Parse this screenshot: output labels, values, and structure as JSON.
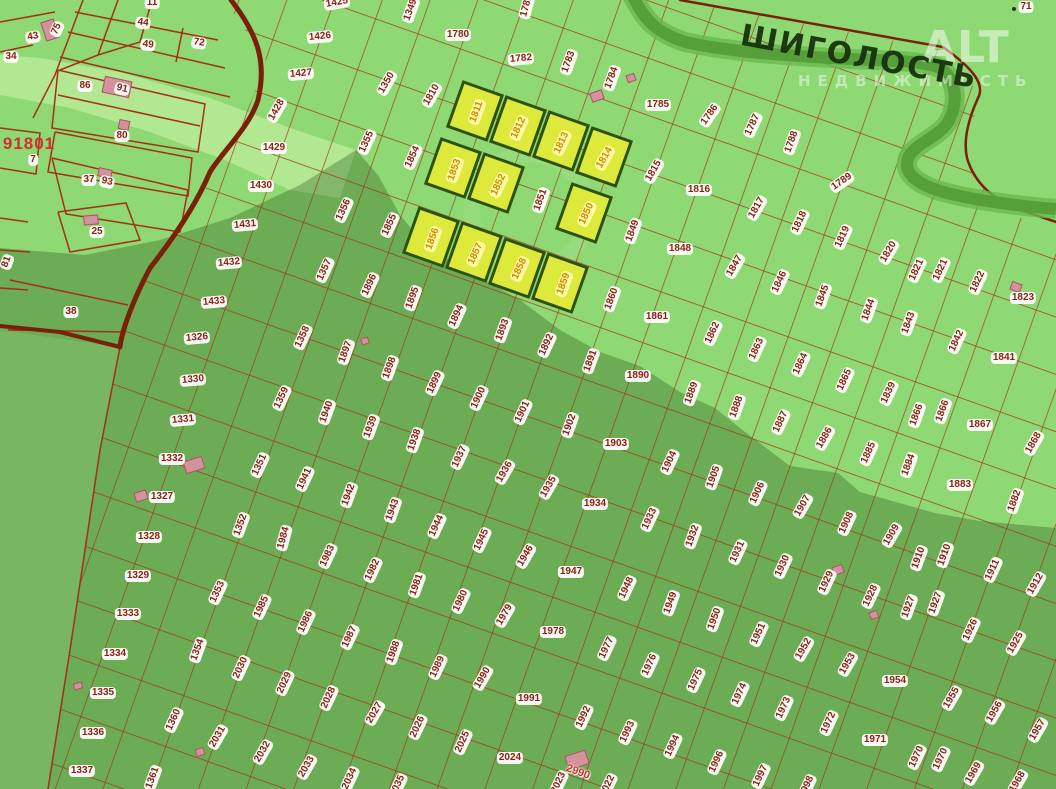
{
  "place": {
    "name": "ШИГОЛОСТЬ"
  },
  "watermark": {
    "brand": "ALT",
    "tagline": "НЕДВИЖИМОСТЬ"
  },
  "colors": {
    "background_green": "#8ed973",
    "shadow_overlay": "rgba(25,70,15,0.30)",
    "parcel_line": "#a43016",
    "road": "#7a2008",
    "river": "#569f3b",
    "label_text": "#8c1d12",
    "label_bg": "#ffffff",
    "highlight_parcel_fill": "#dde93b",
    "highlight_parcel_border": "#2c5212",
    "highlight_label_text": "#d28a00",
    "highlight_label_bg": "#fffaaa",
    "building_pink": "#d3939c",
    "red_text": "#d32f2f",
    "place_text": "#17320d"
  },
  "highlighted_parcels": {
    "size": {
      "w": 44,
      "h": 50,
      "rotation": 19.5
    },
    "centers": [
      [
        475,
        111
      ],
      [
        518,
        126
      ],
      [
        561,
        141
      ],
      [
        604,
        157
      ],
      [
        453,
        168
      ],
      [
        496,
        183
      ],
      [
        584,
        213
      ],
      [
        431,
        237
      ],
      [
        474,
        252
      ],
      [
        517,
        268
      ],
      [
        560,
        283
      ]
    ]
  },
  "buildings": [
    [
      50,
      30,
      14,
      20,
      -18
    ],
    [
      117,
      87,
      28,
      17,
      12
    ],
    [
      124,
      125,
      11,
      10,
      12
    ],
    [
      105,
      173,
      14,
      9,
      12
    ],
    [
      91,
      220,
      15,
      10,
      -5
    ],
    [
      597,
      96,
      13,
      10,
      -20
    ],
    [
      631,
      78,
      9,
      8,
      -20
    ],
    [
      194,
      465,
      20,
      13,
      -18
    ],
    [
      141,
      496,
      13,
      10,
      -18
    ],
    [
      365,
      341,
      8,
      7,
      -20
    ],
    [
      1016,
      287,
      9,
      11,
      -70
    ],
    [
      838,
      570,
      11,
      9,
      -20
    ],
    [
      874,
      615,
      9,
      8,
      -20
    ],
    [
      577,
      760,
      22,
      15,
      -18
    ],
    [
      200,
      752,
      9,
      8,
      -20
    ],
    [
      78,
      686,
      9,
      7,
      -18
    ]
  ],
  "labels": [
    [
      "11",
      152,
      3,
      0,
      0
    ],
    [
      "44",
      143,
      23,
      8,
      0
    ],
    [
      "49",
      148,
      45,
      8,
      0
    ],
    [
      "72",
      199,
      43,
      8,
      0
    ],
    [
      "43",
      33,
      37,
      -10,
      0
    ],
    [
      "75",
      57,
      29,
      -65,
      0
    ],
    [
      "34",
      11,
      57,
      0,
      0
    ],
    [
      "86",
      85,
      86,
      0,
      0
    ],
    [
      "91",
      122,
      89,
      12,
      0
    ],
    [
      "80",
      122,
      136,
      0,
      0
    ],
    [
      "7",
      33,
      160,
      0,
      0
    ],
    [
      "37",
      89,
      180,
      0,
      0
    ],
    [
      "93",
      107,
      182,
      12,
      0
    ],
    [
      "25",
      97,
      232,
      0,
      0
    ],
    [
      "81",
      7,
      262,
      -70,
      0
    ],
    [
      "38",
      71,
      312,
      0,
      0
    ],
    [
      "91801",
      29,
      144,
      0,
      3
    ],
    [
      "71",
      1026,
      7,
      0,
      0
    ],
    [
      "1425",
      337,
      3,
      -10,
      0
    ],
    [
      "1426",
      320,
      37,
      -5,
      0
    ],
    [
      "1427",
      301,
      74,
      -5,
      0
    ],
    [
      "1428",
      277,
      110,
      -60,
      0
    ],
    [
      "1429",
      274,
      148,
      0,
      0
    ],
    [
      "1430",
      261,
      186,
      0,
      0
    ],
    [
      "1431",
      245,
      225,
      -5,
      0
    ],
    [
      "1432",
      229,
      263,
      -5,
      0
    ],
    [
      "1433",
      214,
      302,
      -5,
      0
    ],
    [
      "1326",
      197,
      338,
      -5,
      0
    ],
    [
      "1330",
      193,
      380,
      -5,
      0
    ],
    [
      "1331",
      183,
      420,
      -5,
      0
    ],
    [
      "1349",
      411,
      10,
      -70,
      0
    ],
    [
      "1350",
      387,
      83,
      -60,
      0
    ],
    [
      "1355",
      367,
      142,
      -65,
      0
    ],
    [
      "1356",
      344,
      210,
      -65,
      0
    ],
    [
      "1357",
      325,
      270,
      -65,
      0
    ],
    [
      "1358",
      303,
      337,
      -65,
      0
    ],
    [
      "1359",
      282,
      398,
      -65,
      0
    ],
    [
      "1780",
      458,
      35,
      0,
      0
    ],
    [
      "1781",
      527,
      6,
      -75,
      0
    ],
    [
      "1782",
      521,
      59,
      -5,
      0
    ],
    [
      "1783",
      569,
      62,
      -70,
      0
    ],
    [
      "1784",
      612,
      78,
      -70,
      0
    ],
    [
      "1785",
      658,
      105,
      0,
      0
    ],
    [
      "1786",
      710,
      115,
      -55,
      0
    ],
    [
      "1787",
      753,
      125,
      -65,
      0
    ],
    [
      "1788",
      792,
      142,
      -70,
      0
    ],
    [
      "1789",
      842,
      182,
      -35,
      0
    ],
    [
      "1810",
      432,
      95,
      -60,
      0
    ],
    [
      "1854",
      413,
      157,
      -65,
      0
    ],
    [
      "1855",
      390,
      225,
      -65,
      0
    ],
    [
      "1811",
      477,
      112,
      -70,
      1
    ],
    [
      "1812",
      519,
      128,
      -65,
      1
    ],
    [
      "1813",
      562,
      143,
      -65,
      1
    ],
    [
      "1814",
      605,
      158,
      -60,
      1
    ],
    [
      "1853",
      455,
      170,
      -70,
      1
    ],
    [
      "1852",
      499,
      185,
      -65,
      1
    ],
    [
      "1850",
      587,
      214,
      -65,
      1
    ],
    [
      "1856",
      433,
      239,
      -70,
      1
    ],
    [
      "1857",
      476,
      254,
      -65,
      1
    ],
    [
      "1858",
      520,
      269,
      -65,
      1
    ],
    [
      "1859",
      564,
      284,
      -70,
      1
    ],
    [
      "1851",
      541,
      200,
      -70,
      0
    ],
    [
      "1815",
      654,
      171,
      -60,
      0
    ],
    [
      "1816",
      699,
      190,
      0,
      0
    ],
    [
      "1817",
      757,
      208,
      -60,
      0
    ],
    [
      "1818",
      800,
      222,
      -65,
      0
    ],
    [
      "1819",
      843,
      237,
      -65,
      0
    ],
    [
      "1820",
      889,
      252,
      -60,
      0
    ],
    [
      "1821",
      917,
      270,
      -65,
      0
    ],
    [
      "1821",
      941,
      270,
      -65,
      0
    ],
    [
      "1822",
      978,
      282,
      -65,
      0
    ],
    [
      "1823",
      1023,
      298,
      0,
      0
    ],
    [
      "1849",
      633,
      231,
      -70,
      0
    ],
    [
      "1848",
      680,
      249,
      0,
      0
    ],
    [
      "1847",
      735,
      266,
      -60,
      0
    ],
    [
      "1846",
      780,
      282,
      -65,
      0
    ],
    [
      "1845",
      823,
      296,
      -70,
      0
    ],
    [
      "1844",
      869,
      310,
      -70,
      0
    ],
    [
      "1843",
      909,
      323,
      -70,
      0
    ],
    [
      "1842",
      957,
      341,
      -65,
      0
    ],
    [
      "1841",
      1004,
      358,
      0,
      0
    ],
    [
      "1860",
      612,
      299,
      -70,
      0
    ],
    [
      "1861",
      657,
      317,
      0,
      0
    ],
    [
      "1862",
      713,
      333,
      -65,
      0
    ],
    [
      "1863",
      757,
      349,
      -65,
      0
    ],
    [
      "1864",
      801,
      364,
      -65,
      0
    ],
    [
      "1865",
      845,
      380,
      -65,
      0
    ],
    [
      "1839",
      889,
      393,
      -65,
      0
    ],
    [
      "1866",
      917,
      415,
      -70,
      0
    ],
    [
      "1866",
      943,
      411,
      -70,
      0
    ],
    [
      "1867",
      980,
      425,
      0,
      0
    ],
    [
      "1868",
      1034,
      443,
      -60,
      0
    ],
    [
      "1885",
      869,
      453,
      -65,
      0
    ],
    [
      "1884",
      909,
      465,
      -70,
      0
    ],
    [
      "1883",
      960,
      485,
      0,
      0
    ],
    [
      "1882",
      1015,
      501,
      -70,
      0
    ],
    [
      "1896",
      370,
      285,
      -65,
      0
    ],
    [
      "1895",
      413,
      298,
      -70,
      0
    ],
    [
      "1894",
      457,
      316,
      -65,
      0
    ],
    [
      "1893",
      503,
      330,
      -70,
      0
    ],
    [
      "1892",
      547,
      345,
      -65,
      0
    ],
    [
      "1891",
      591,
      361,
      -70,
      0
    ],
    [
      "1890",
      638,
      376,
      0,
      0
    ],
    [
      "1889",
      692,
      393,
      -70,
      0
    ],
    [
      "1888",
      737,
      407,
      -70,
      0
    ],
    [
      "1887",
      781,
      422,
      -65,
      0
    ],
    [
      "1886",
      825,
      438,
      -60,
      0
    ],
    [
      "1897",
      346,
      352,
      -70,
      0
    ],
    [
      "1898",
      390,
      368,
      -70,
      0
    ],
    [
      "1899",
      435,
      383,
      -65,
      0
    ],
    [
      "1900",
      479,
      398,
      -65,
      0
    ],
    [
      "1901",
      523,
      412,
      -65,
      0
    ],
    [
      "1902",
      570,
      425,
      -70,
      0
    ],
    [
      "1940",
      327,
      412,
      -70,
      0
    ],
    [
      "1939",
      371,
      427,
      -70,
      0
    ],
    [
      "1938",
      415,
      440,
      -70,
      0
    ],
    [
      "1937",
      460,
      457,
      -65,
      0
    ],
    [
      "1936",
      505,
      472,
      -60,
      0
    ],
    [
      "1935",
      549,
      487,
      -60,
      0
    ],
    [
      "1903",
      616,
      444,
      0,
      0
    ],
    [
      "1904",
      670,
      462,
      -65,
      0
    ],
    [
      "1905",
      714,
      477,
      -70,
      0
    ],
    [
      "1906",
      758,
      493,
      -65,
      0
    ],
    [
      "1907",
      803,
      506,
      -60,
      0
    ],
    [
      "1908",
      847,
      523,
      -65,
      0
    ],
    [
      "1941",
      305,
      479,
      -65,
      0
    ],
    [
      "1942",
      349,
      495,
      -70,
      0
    ],
    [
      "1943",
      393,
      510,
      -70,
      0
    ],
    [
      "1944",
      437,
      526,
      -65,
      0
    ],
    [
      "1945",
      482,
      540,
      -65,
      0
    ],
    [
      "1946",
      526,
      556,
      -60,
      0
    ],
    [
      "1947",
      571,
      572,
      0,
      0
    ],
    [
      "1934",
      595,
      504,
      0,
      0
    ],
    [
      "1933",
      650,
      519,
      -65,
      0
    ],
    [
      "1932",
      693,
      536,
      -70,
      0
    ],
    [
      "1931",
      738,
      552,
      -65,
      0
    ],
    [
      "1930",
      783,
      566,
      -65,
      0
    ],
    [
      "1929",
      827,
      582,
      -65,
      0
    ],
    [
      "1928",
      871,
      596,
      -65,
      0
    ],
    [
      "1984",
      284,
      538,
      -75,
      0
    ],
    [
      "1983",
      328,
      556,
      -65,
      0
    ],
    [
      "1982",
      373,
      570,
      -65,
      0
    ],
    [
      "1981",
      417,
      585,
      -70,
      0
    ],
    [
      "1980",
      461,
      601,
      -65,
      0
    ],
    [
      "1979",
      505,
      615,
      -60,
      0
    ],
    [
      "1978",
      553,
      632,
      0,
      0
    ],
    [
      "1948",
      627,
      588,
      -65,
      0
    ],
    [
      "1949",
      671,
      603,
      -70,
      0
    ],
    [
      "1950",
      715,
      619,
      -70,
      0
    ],
    [
      "1951",
      759,
      634,
      -65,
      0
    ],
    [
      "1952",
      804,
      649,
      -60,
      0
    ],
    [
      "1953",
      848,
      664,
      -60,
      0
    ],
    [
      "1909",
      892,
      535,
      -60,
      0
    ],
    [
      "1910",
      919,
      558,
      -70,
      0
    ],
    [
      "1910",
      945,
      555,
      -70,
      0
    ],
    [
      "1911",
      993,
      570,
      -65,
      0
    ],
    [
      "1912",
      1036,
      584,
      -60,
      0
    ],
    [
      "1927",
      909,
      607,
      -70,
      0
    ],
    [
      "1927",
      936,
      603,
      -70,
      0
    ],
    [
      "1926",
      971,
      630,
      -65,
      0
    ],
    [
      "1925",
      1016,
      643,
      -60,
      0
    ],
    [
      "1986",
      306,
      622,
      -65,
      0
    ],
    [
      "1987",
      350,
      637,
      -65,
      0
    ],
    [
      "1988",
      394,
      652,
      -70,
      0
    ],
    [
      "1989",
      438,
      667,
      -65,
      0
    ],
    [
      "1990",
      483,
      678,
      -60,
      0
    ],
    [
      "1977",
      607,
      648,
      -65,
      0
    ],
    [
      "1976",
      650,
      665,
      -65,
      0
    ],
    [
      "1975",
      696,
      680,
      -65,
      0
    ],
    [
      "1974",
      740,
      694,
      -65,
      0
    ],
    [
      "1973",
      784,
      708,
      -65,
      0
    ],
    [
      "1972",
      829,
      723,
      -65,
      0
    ],
    [
      "1971",
      875,
      740,
      0,
      0
    ],
    [
      "1954",
      895,
      681,
      0,
      0
    ],
    [
      "1955",
      952,
      698,
      -60,
      0
    ],
    [
      "1956",
      995,
      712,
      -60,
      0
    ],
    [
      "1957",
      1038,
      730,
      -60,
      0
    ],
    [
      "1970",
      917,
      757,
      -65,
      0
    ],
    [
      "1970",
      941,
      759,
      -65,
      0
    ],
    [
      "1969",
      974,
      773,
      -60,
      0
    ],
    [
      "1968",
      1018,
      782,
      -60,
      0
    ],
    [
      "1996",
      717,
      762,
      -65,
      0
    ],
    [
      "1997",
      761,
      776,
      -65,
      0
    ],
    [
      "1998",
      807,
      787,
      -65,
      0
    ],
    [
      "1992",
      584,
      717,
      -65,
      0
    ],
    [
      "1993",
      628,
      732,
      -65,
      0
    ],
    [
      "1994",
      673,
      746,
      -65,
      0
    ],
    [
      "1991",
      529,
      699,
      0,
      0
    ],
    [
      "2023",
      559,
      783,
      -65,
      0
    ],
    [
      "2022",
      608,
      786,
      -65,
      0
    ],
    [
      "2024",
      510,
      758,
      0,
      0
    ],
    [
      "2025",
      463,
      742,
      -65,
      0
    ],
    [
      "2026",
      418,
      727,
      -65,
      0
    ],
    [
      "2027",
      375,
      713,
      -60,
      0
    ],
    [
      "2028",
      329,
      698,
      -65,
      0
    ],
    [
      "2029",
      285,
      683,
      -65,
      0
    ],
    [
      "2030",
      241,
      668,
      -65,
      0
    ],
    [
      "2031",
      218,
      737,
      -60,
      0
    ],
    [
      "2032",
      263,
      752,
      -60,
      0
    ],
    [
      "2033",
      307,
      767,
      -60,
      0
    ],
    [
      "2034",
      350,
      779,
      -65,
      0
    ],
    [
      "2035",
      398,
      786,
      -65,
      0
    ],
    [
      "1351",
      260,
      465,
      -65,
      0
    ],
    [
      "1352",
      241,
      525,
      -70,
      0
    ],
    [
      "1353",
      218,
      592,
      -65,
      0
    ],
    [
      "1354",
      198,
      650,
      -70,
      0
    ],
    [
      "1985",
      262,
      607,
      -65,
      0
    ],
    [
      "1327",
      162,
      497,
      0,
      0
    ],
    [
      "1328",
      149,
      537,
      0,
      0
    ],
    [
      "1329",
      138,
      576,
      0,
      0
    ],
    [
      "1332",
      172,
      459,
      0,
      0
    ],
    [
      "1333",
      128,
      614,
      0,
      0
    ],
    [
      "1334",
      115,
      654,
      0,
      0
    ],
    [
      "1335",
      103,
      693,
      0,
      0
    ],
    [
      "1336",
      93,
      733,
      0,
      0
    ],
    [
      "1337",
      82,
      771,
      0,
      0
    ],
    [
      "1360",
      174,
      720,
      -65,
      0
    ],
    [
      "1361",
      153,
      778,
      -70,
      0
    ],
    [
      "2990",
      578,
      772,
      20,
      2
    ]
  ]
}
